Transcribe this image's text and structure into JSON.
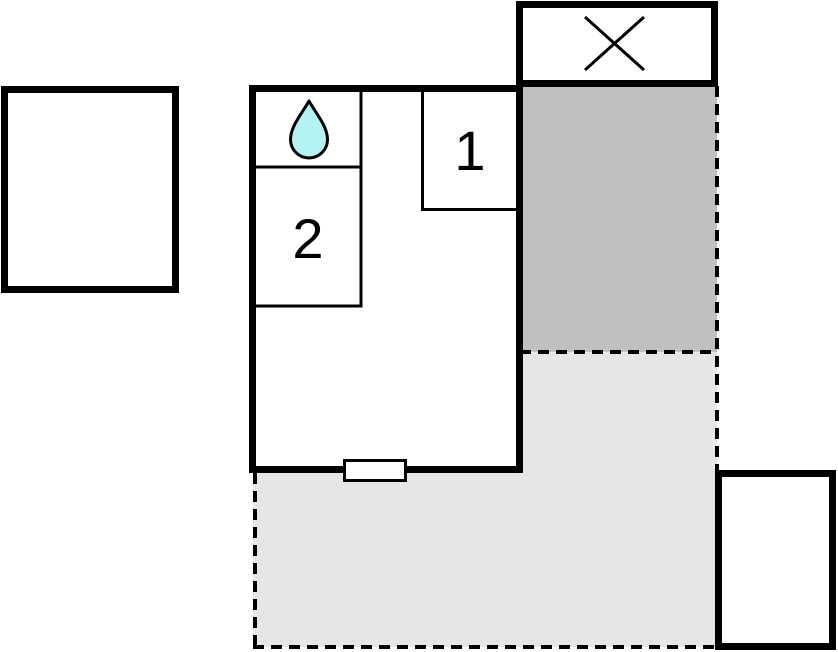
{
  "title": "holiday-home-floor-plan",
  "rooms": [
    {
      "id": "room-1",
      "label": "1"
    },
    {
      "id": "room-2",
      "label": "2"
    }
  ],
  "bathroom": {
    "icon": "water-drop-icon"
  },
  "outbuilding": {
    "icon": "x-cross-icon"
  },
  "areas": {
    "covered_terrace": "dark-gray-area",
    "open_terrace": "light-gray-dashed-area"
  },
  "colors": {
    "background": "#ffffff",
    "wall": "#000000",
    "room_fill": "#ffffff",
    "terrace_dark": "#c0c0c0",
    "terrace_light": "#e6e6e6",
    "water_drop_fill": "#b5f2f2"
  }
}
